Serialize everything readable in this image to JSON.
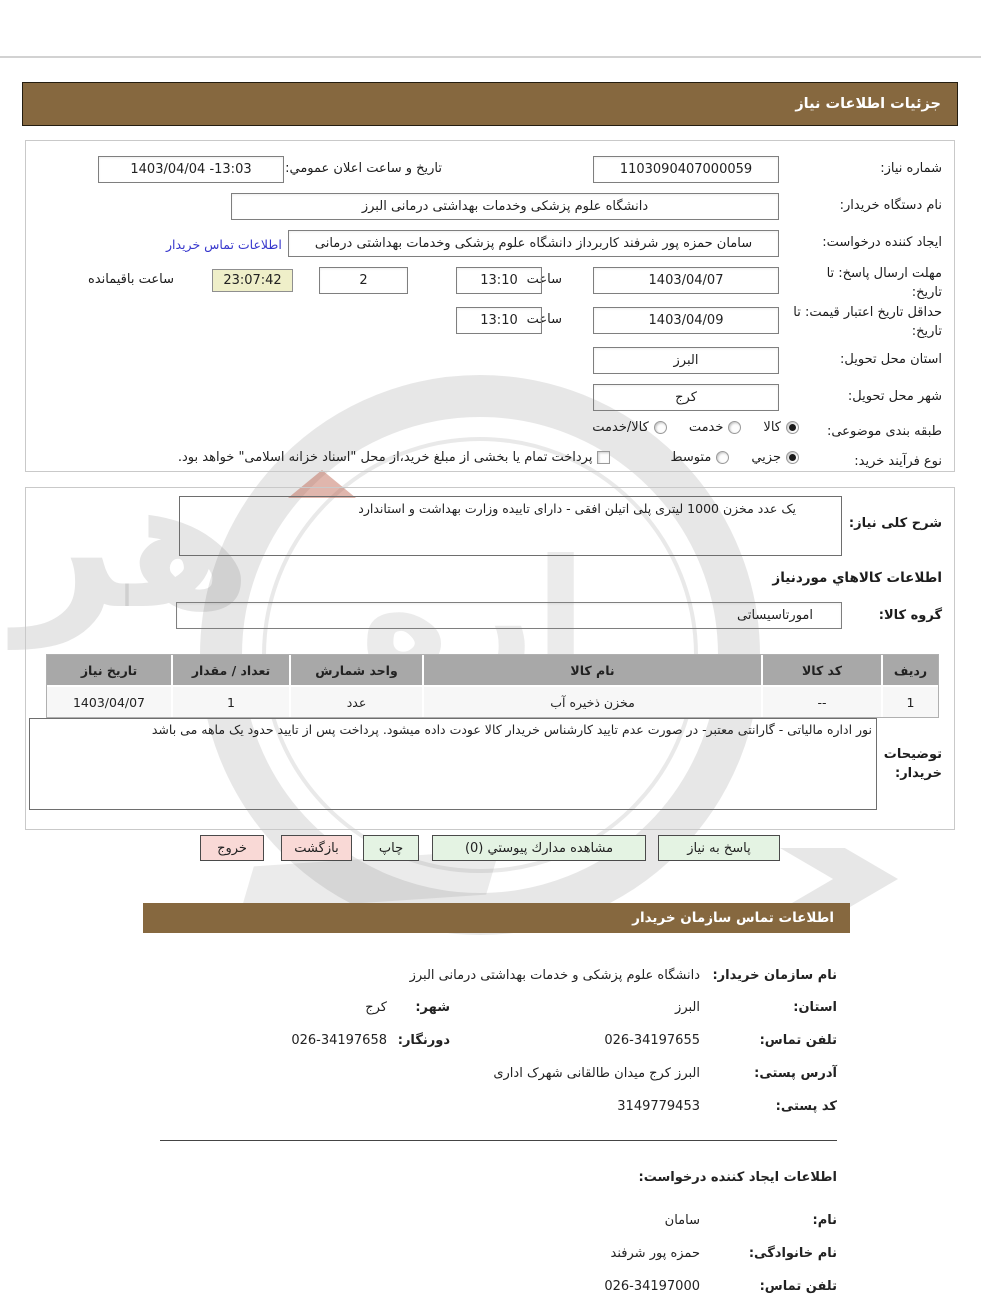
{
  "colors": {
    "brand_brown": "#86683F",
    "button_green": "#E4F3E3",
    "button_pink": "#F9D9D6",
    "countdown_bg": "#EFEFC9",
    "link_blue": "#3636cc",
    "table_header_gray": "#A8A8A8"
  },
  "bars": {
    "details_title": "جزئیات اطلاعات نیاز",
    "contact_title": "اطلاعات تماس سازمان خریدار"
  },
  "form": {
    "need_number": {
      "label": "شماره نیاز:",
      "value": "1103090407000059"
    },
    "announce_datetime": {
      "label": "تاریخ و ساعت اعلان عمومي:",
      "value": "1403/04/04 -13:03"
    },
    "buyer_org": {
      "label": "نام دستگاه خریدار:",
      "value": "دانشگاه علوم پزشکی وخدمات بهداشتی درمانی البرز"
    },
    "request_creator": {
      "label": "ایجاد کننده درخواست:",
      "value": "سامان حمزه پور شرفند کاربرداز دانشگاه علوم پزشکی وخدمات بهداشتی درمانی",
      "contact_link": "اطلاعات تماس خریدار"
    },
    "reply_deadline": {
      "label": "مهلت ارسال پاسخ: تا تاریخ:",
      "date": "1403/04/07",
      "hour_label": "ساعت",
      "time": "13:10",
      "days": "2",
      "days_label": "روز و",
      "countdown": "23:07:42",
      "remaining_label": "ساعت باقیمانده"
    },
    "price_validity": {
      "label": "حداقل تاریخ اعتبار قیمت: تا تاریخ:",
      "date": "1403/04/09",
      "hour_label": "ساعت",
      "time": "13:10"
    },
    "province": {
      "label": "استان محل تحویل:",
      "value": "البرز"
    },
    "city": {
      "label": "شهر محل تحویل:",
      "value": "کرج"
    },
    "classification": {
      "label": "طبقه بندی موضوعی:",
      "options": [
        {
          "label": "کالا",
          "selected": true
        },
        {
          "label": "خدمت",
          "selected": false
        },
        {
          "label": "کالا/خدمت",
          "selected": false
        }
      ]
    },
    "process_type": {
      "label": "نوع فرآیند خرید:",
      "options": [
        {
          "label": "جزيي",
          "selected": true
        },
        {
          "label": "متوسط",
          "selected": false
        }
      ],
      "checkbox_label": "پرداخت تمام یا بخشی از مبلغ خرید،از محل \"اسناد خزانه اسلامی\" خواهد بود.",
      "checkbox_checked": false
    }
  },
  "need_desc": {
    "label": "شرح کلی نیاز:",
    "value": "یک عدد مخزن 1000 لیتری پلی اتیلن افقی - دارای تاییده وزارت بهداشت و استاندارد"
  },
  "goods": {
    "heading": "اطلاعات کالاهاي موردنیاز",
    "group": {
      "label": "گروه کالا:",
      "value": "امورتاسیساتی"
    },
    "table": {
      "headers": [
        "ردیف",
        "کد کالا",
        "نام کالا",
        "واحد شمارش",
        "تعداد / مقدار",
        "تاریخ نیاز"
      ],
      "rows": [
        [
          "1",
          "--",
          "مخزن ذخیره آب",
          "عدد",
          "1",
          "1403/04/07"
        ]
      ]
    },
    "buyer_notes": {
      "label": "توضیحات خریدار:",
      "value": "نور اداره مالیاتی - گارانتی معتبر- در صورت عدم تایید کارشناس خریدار کالا عودت داده میشود. پرداخت پس از تایید حدود یک ماهه می باشد"
    }
  },
  "buttons": {
    "reply": "پاسخ به نیاز",
    "attachments": "مشاهده مدارك پیوستي (0)",
    "print": "چاپ",
    "back": "بازگشت",
    "exit": "خروج"
  },
  "contact": {
    "org": {
      "label": "نام سازمان خریدار:",
      "value": "دانشگاه علوم پزشکی و خدمات بهداشتی  درمانی البرز"
    },
    "province": {
      "label": "استان:",
      "value": "البرز"
    },
    "city": {
      "label": "شهر:",
      "value": "کرج"
    },
    "phone": {
      "label": "تلفن تماس:",
      "value": "026-34197655"
    },
    "fax": {
      "label": "دورنگار:",
      "value": "026-34197658"
    },
    "address": {
      "label": "آدرس پستی:",
      "value": "البرز کرج میدان طالقانی شهرک اداری"
    },
    "postal_code": {
      "label": "کد پستی:",
      "value": "3149779453"
    }
  },
  "creator": {
    "heading": "اطلاعات ایجاد کننده درخواست:",
    "first_name": {
      "label": "نام:",
      "value": "سامان"
    },
    "last_name": {
      "label": "نام خانوادگی:",
      "value": "حمزه پور شرفند"
    },
    "phone": {
      "label": "تلفن تماس:",
      "value": "026-34197000"
    }
  },
  "watermark": {
    "text_left": "هر",
    "text_mid": "اره"
  }
}
